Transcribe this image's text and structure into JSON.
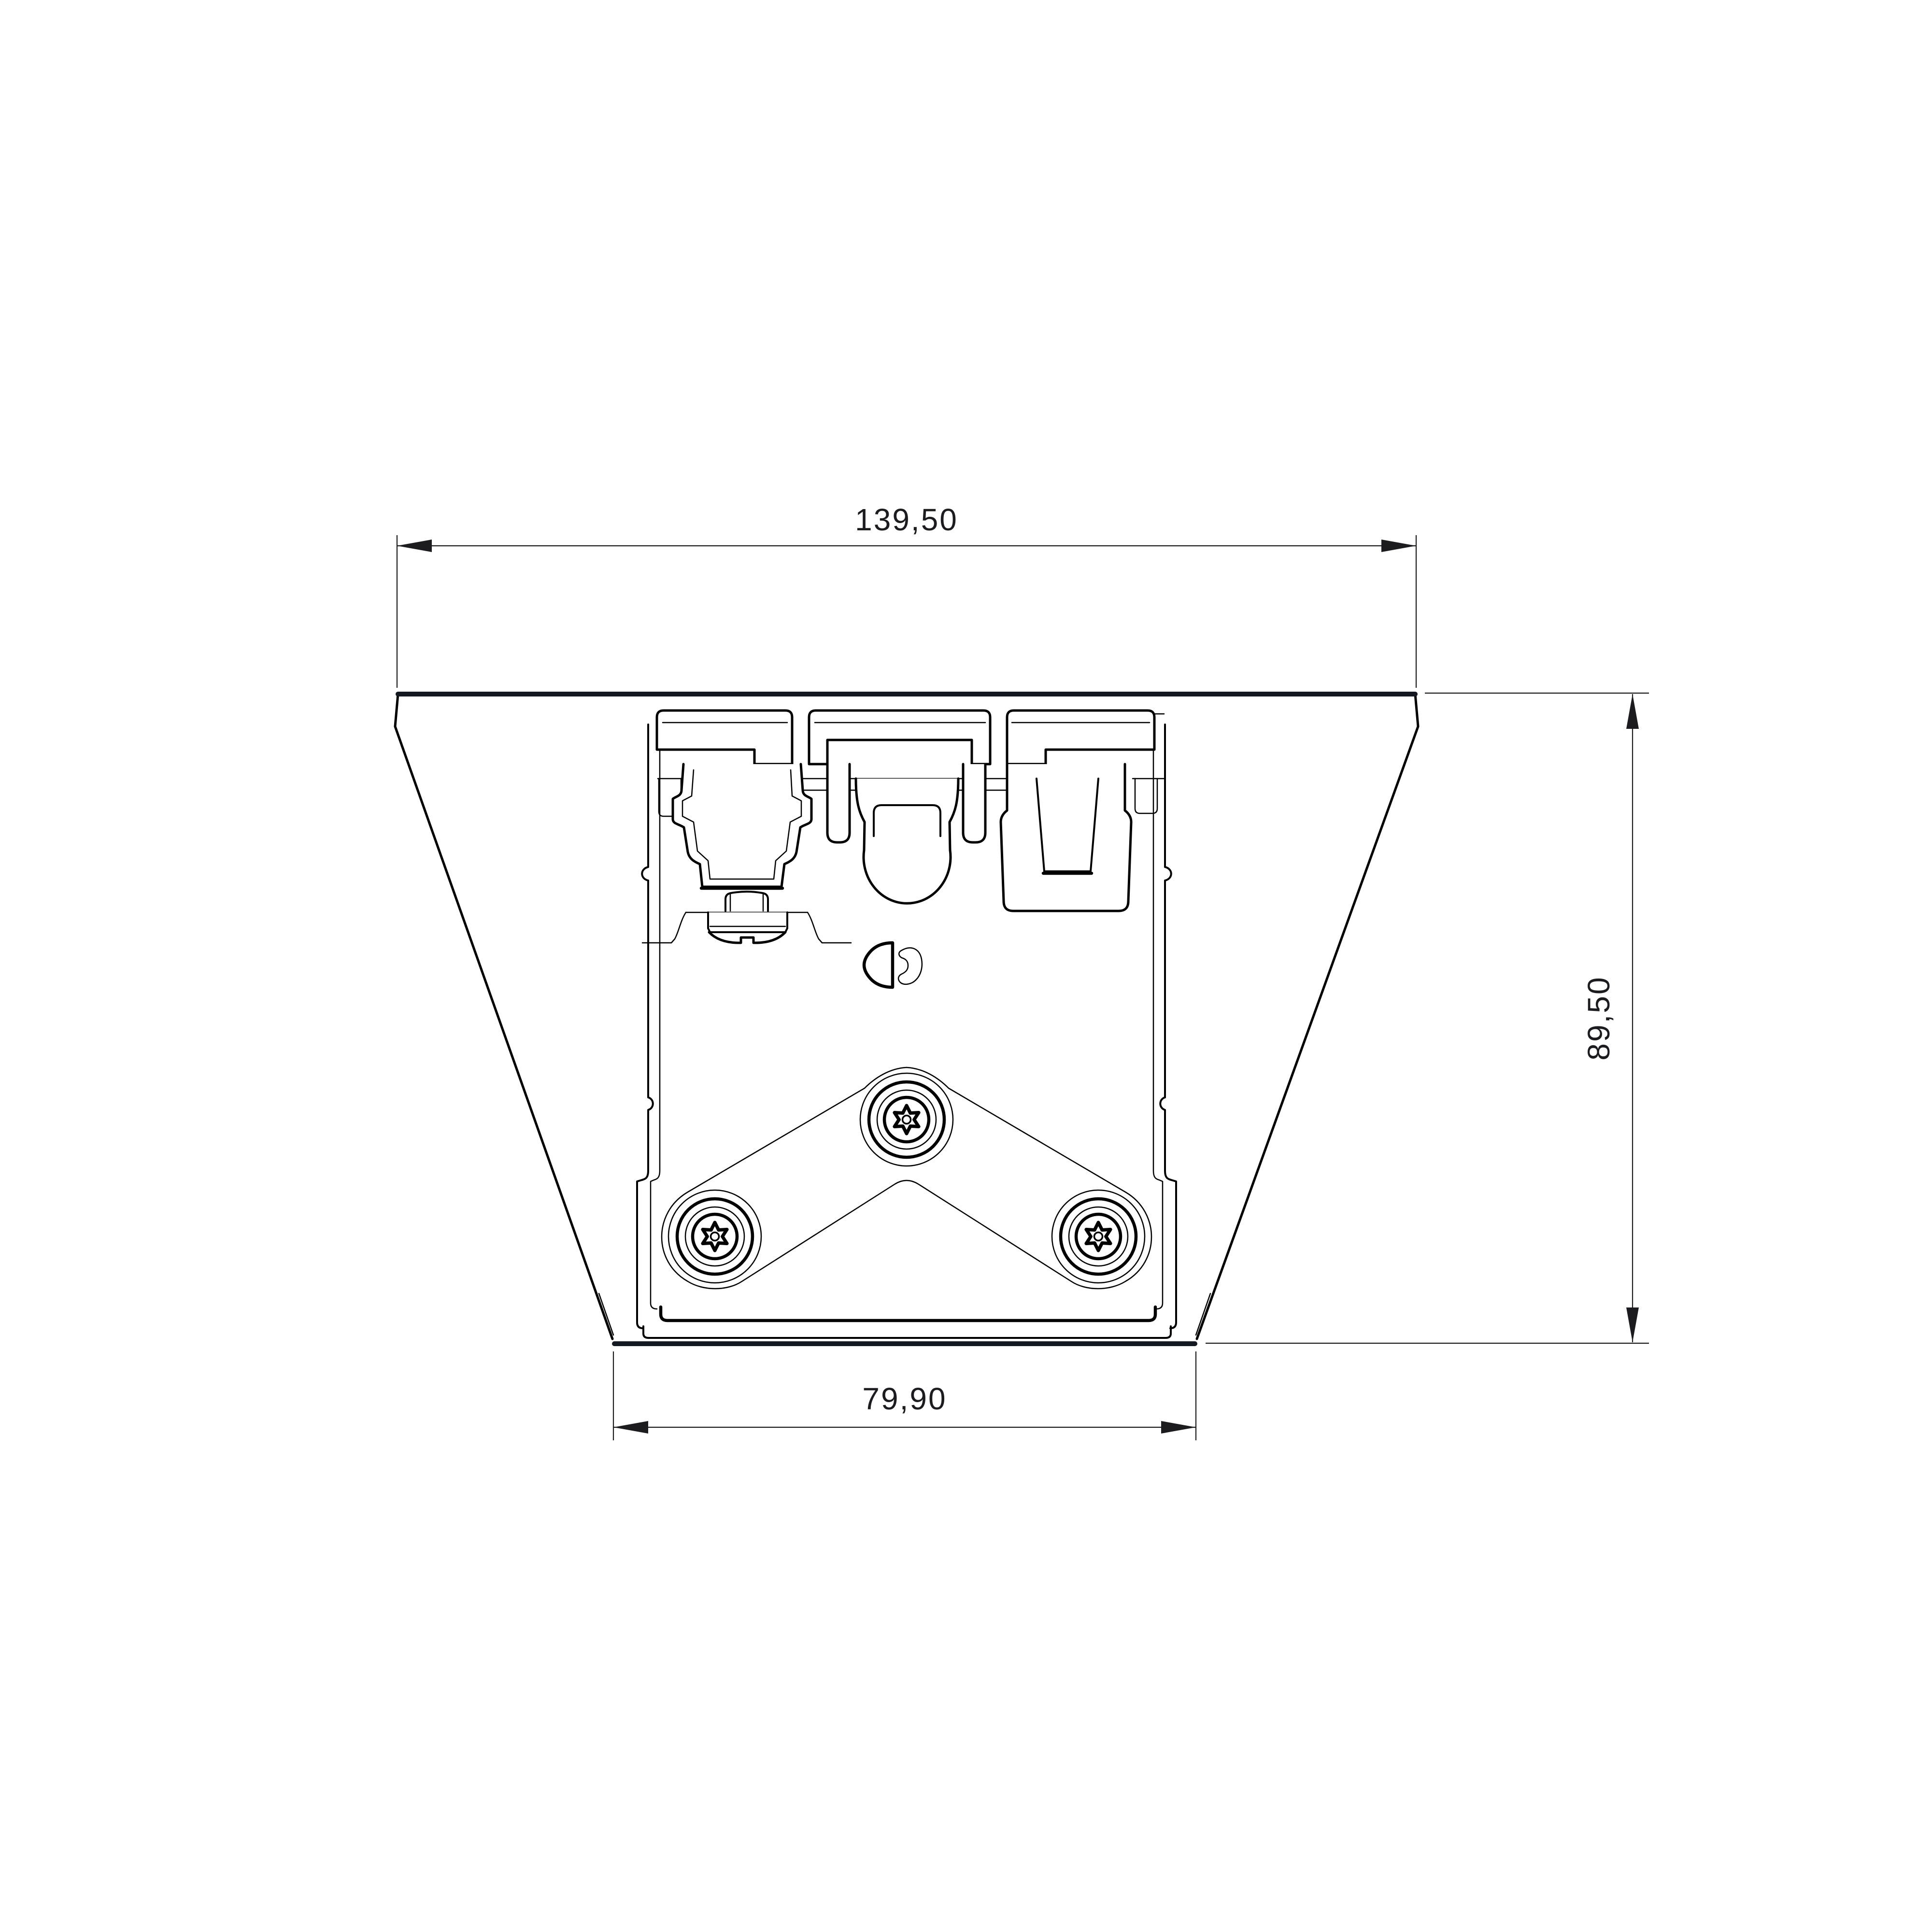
{
  "document": {
    "type": "technical-drawing",
    "view": "front-profile-section",
    "subject": "mounting-bracket-extrusion"
  },
  "dimensions": {
    "top_width": "139,50",
    "height": "89,50",
    "bottom_width": "79,90"
  },
  "colors": {
    "background": "#ffffff",
    "line": "#000000",
    "face_edge": "#141821",
    "dimension": "#1c1c1e"
  }
}
